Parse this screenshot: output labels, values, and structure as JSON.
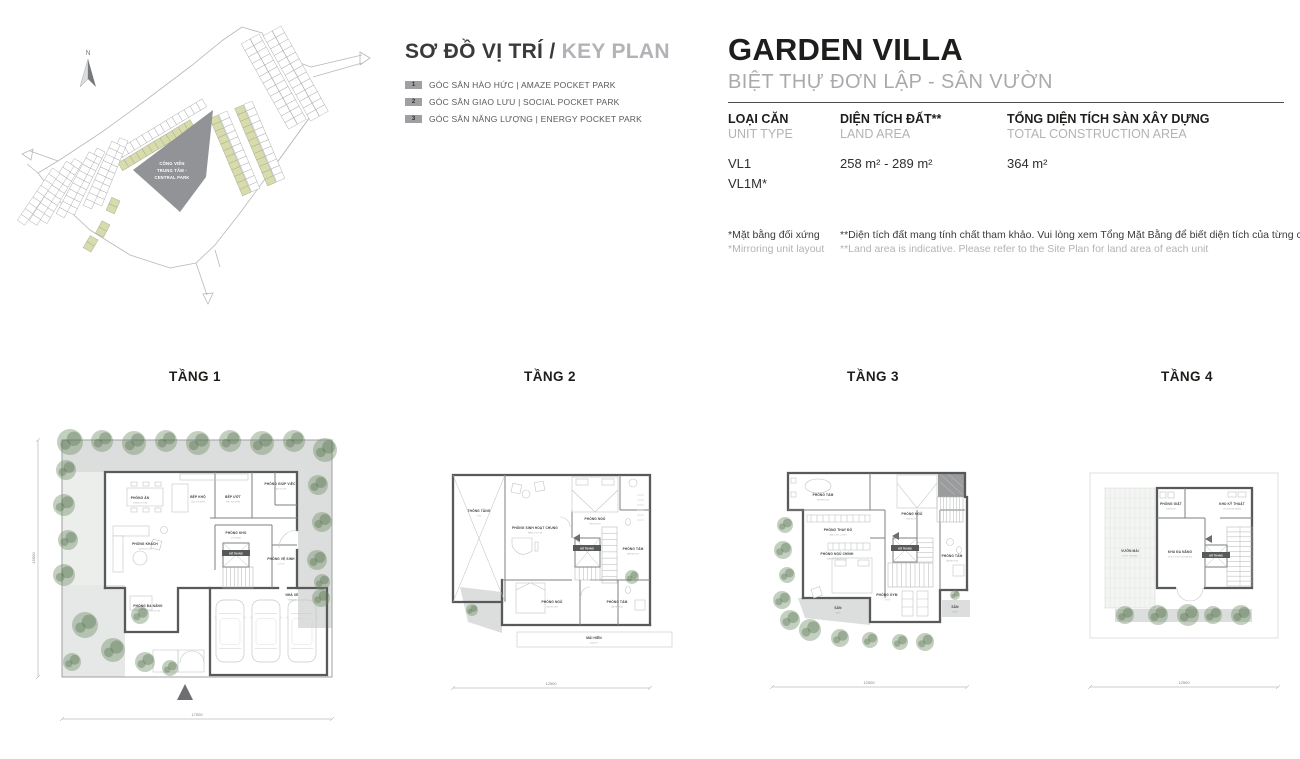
{
  "key_plan": {
    "title_vi": "SƠ ĐỒ VỊ TRÍ / ",
    "title_en": "KEY PLAN",
    "north_label": "N",
    "park_line1": "CÔNG VIÊN",
    "park_line2": "TRUNG TÂM -",
    "park_line3": "CENTRAL PARK",
    "legend": [
      {
        "num": "1",
        "label": "GÓC SÂN HÀO HỨC | AMAZE POCKET PARK"
      },
      {
        "num": "2",
        "label": "GÓC SÂN GIAO LƯU | SOCIAL POCKET PARK"
      },
      {
        "num": "3",
        "label": "GÓC SÂN NĂNG LƯỢNG | ENERGY POCKET PARK"
      }
    ]
  },
  "header": {
    "title": "GARDEN VILLA",
    "subtitle": "BIỆT THỰ ĐƠN LẬP - SÂN VƯỜN",
    "columns": [
      {
        "vi": "LOẠI CĂN",
        "en": "UNIT TYPE",
        "value1": "VL1",
        "value2": "VL1M*"
      },
      {
        "vi": "DIỆN TÍCH ĐẤT**",
        "en": "LAND AREA",
        "value1": "258 m² - 289 m²",
        "value2": ""
      },
      {
        "vi": "TỔNG DIỆN TÍCH SÀN XÂY DỰNG",
        "en": "TOTAL CONSTRUCTION AREA",
        "value1": "364 m²",
        "value2": ""
      }
    ],
    "footnote1_vi": "*Mặt bằng đối xứng",
    "footnote1_en": "*Mirroring unit layout",
    "footnote2_vi": "**Diện tích đất mang tính chất tham khảo. Vui lòng xem Tổng Mặt Bằng để biết diện tích của từng căn",
    "footnote2_en": "**Land area is indicative. Please refer to the Site Plan for land area of each unit"
  },
  "floors": [
    {
      "label": "TẦNG 1",
      "dim_bottom": "17000",
      "dim_left": "15000",
      "rooms": [
        {
          "name": "PHÒNG ĂN",
          "sub": "DINING ROOM"
        },
        {
          "name": "BẾP KHÔ",
          "sub": "DRY KITCHEN"
        },
        {
          "name": "BẾP ƯỚT",
          "sub": "WET KITCHEN"
        },
        {
          "name": "PHÒNG GIÚP VIỆC",
          "sub": "MAID ROOM"
        },
        {
          "name": "PHÒNG KHÁCH",
          "sub": "LIVING ROOM"
        },
        {
          "name": "PHÒNG KHO",
          "sub": "STORAGE"
        },
        {
          "name": "HỐ THANG",
          "sub": ""
        },
        {
          "name": "PHÒNG VỆ SINH",
          "sub": "TOILET"
        },
        {
          "name": "PHÒNG ĐA NĂNG",
          "sub": "MULTI-FUNCTION ROOM"
        },
        {
          "name": "NHÀ XE",
          "sub": "GARAGE"
        }
      ]
    },
    {
      "label": "TẦNG 2",
      "dim_bottom": "12500",
      "rooms": [
        {
          "name": "THÔNG TẦNG",
          "sub": "VOID"
        },
        {
          "name": "PHÒNG SINH HOẠT CHUNG",
          "sub": "FAMILY ROOM"
        },
        {
          "name": "PHÒNG NGỦ",
          "sub": "BEDROOM"
        },
        {
          "name": "HỐ THANG",
          "sub": ""
        },
        {
          "name": "PHÒNG TẮM",
          "sub": "BATHROOM"
        },
        {
          "name": "PHÒNG NGỦ",
          "sub": "BEDROOM"
        },
        {
          "name": "PHÒNG TẮM",
          "sub": "BATHROOM"
        },
        {
          "name": "MÁI HIÊN",
          "sub": "CANOPY"
        }
      ]
    },
    {
      "label": "TẦNG 3",
      "dim_bottom": "12500",
      "rooms": [
        {
          "name": "PHÒNG TẮM",
          "sub": "BATHROOM"
        },
        {
          "name": "PHÒNG NGỦ",
          "sub": "BEDROOM"
        },
        {
          "name": "PHÒNG THAY ĐỒ",
          "sub": "WALK-IN CLOSET"
        },
        {
          "name": "PHÒNG NGỦ CHÍNH",
          "sub": "MASTER BEDROOM"
        },
        {
          "name": "HỐ THANG",
          "sub": ""
        },
        {
          "name": "PHÒNG TẮM",
          "sub": "BATHROOM"
        },
        {
          "name": "PHÒNG GYM",
          "sub": "GYM"
        },
        {
          "name": "SÂN",
          "sub": "YARD"
        },
        {
          "name": "SÂN",
          "sub": "YARD"
        }
      ]
    },
    {
      "label": "TẦNG 4",
      "dim_bottom": "12500",
      "rooms": [
        {
          "name": "VƯỜN MÁI",
          "sub": "ROOF GARDEN"
        },
        {
          "name": "PHÒNG GIẶT",
          "sub": "LAUNDRY"
        },
        {
          "name": "KHU KỸ THUẬT",
          "sub": "TECHNICAL AREA"
        },
        {
          "name": "KHU ĐA NĂNG",
          "sub": "MULTI-FUNCTION AREA"
        },
        {
          "name": "HỐ THANG",
          "sub": ""
        }
      ]
    }
  ]
}
